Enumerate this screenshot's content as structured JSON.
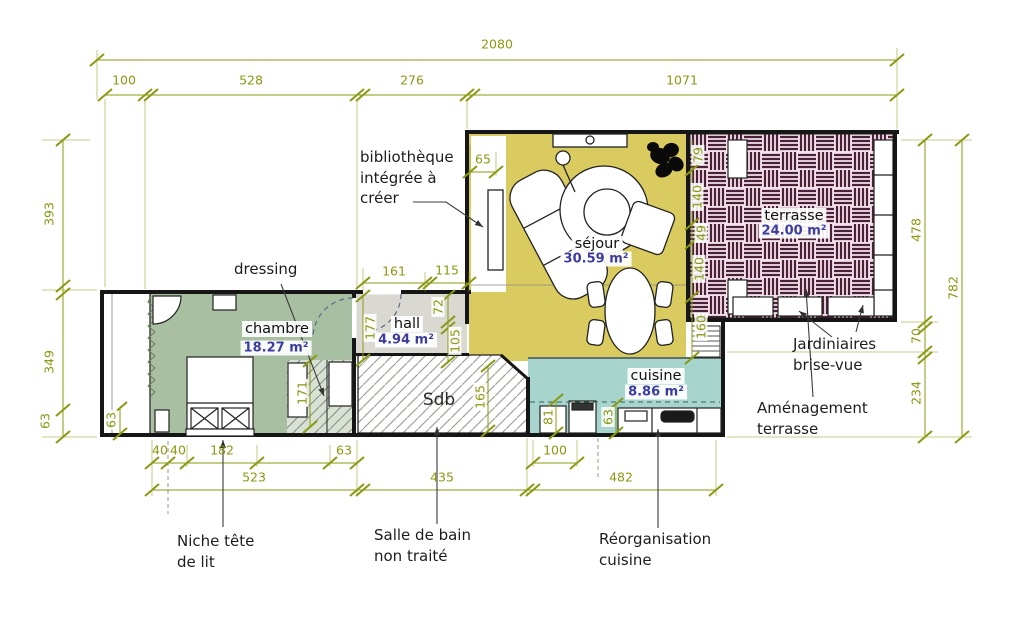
{
  "drawing": {
    "type": "floor-plan-renovation",
    "units": "cm"
  },
  "rooms": {
    "chambre": {
      "name": "chambre",
      "area": "18.27 m²"
    },
    "hall": {
      "name": "hall",
      "area": "4.94 m²"
    },
    "sejour": {
      "name": "séjour",
      "area": "30.59 m²"
    },
    "cuisine": {
      "name": "cuisine",
      "area": "8.86 m²"
    },
    "terrasse": {
      "name": "terrasse",
      "area": "24.00 m²"
    },
    "sdb": {
      "name": "Sdb"
    }
  },
  "notes": {
    "bibliotheque": "bibliothèque\nintégrée à\ncréer",
    "dressing": "dressing",
    "niche": "Niche tête\nde lit",
    "sdb": "Salle de bain\nnon traité",
    "reorganisation": "Réorganisation\ncuisine",
    "jardinieres": "Jardiniaires\nbrise-vue",
    "amenagement": "Aménagement\nterrasse"
  },
  "dim": {
    "total_top": "2080",
    "top": [
      "100",
      "528",
      "276",
      "1071"
    ],
    "left": [
      "393",
      "349"
    ],
    "left_63_outer": "63",
    "left_63_inner": "63",
    "right": [
      "478",
      "70",
      "234"
    ],
    "right_total": "782",
    "bottom1": [
      "40",
      "40",
      "182",
      "63",
      "100"
    ],
    "bottom2": [
      "523",
      "435",
      "482"
    ],
    "inner": {
      "d65": "65",
      "d161": "161",
      "d115": "115",
      "d177": "177",
      "d72": "72",
      "d105": "105",
      "d165": "165",
      "d81": "81",
      "d63": "63",
      "d171": "171"
    },
    "facade": [
      "79",
      "140",
      "49",
      "140",
      "160"
    ]
  },
  "colors": {
    "dimension": "#8a9912",
    "area_value": "#3c3ca0",
    "chambre_fill": "#a9bfa1",
    "sejour_fill": "#d9cb5f",
    "cuisine_fill": "#a7d5cd",
    "hall_fill": "#d9d9d1",
    "terrasse_bg": "#f4e2ea",
    "terrasse_stripe": "#4a2139",
    "wall": "#161616"
  }
}
